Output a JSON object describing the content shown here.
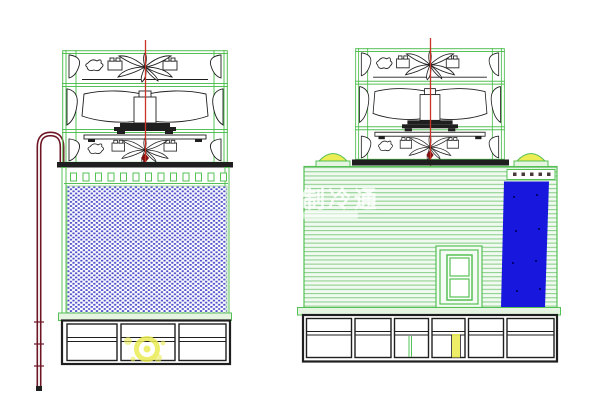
{
  "watermark": {
    "title": "制冷通"
  },
  "drawing": {
    "left_view": "cooling-tower-side-elevation",
    "right_view": "cooling-tower-front-elevation",
    "left_basin_panels": 3,
    "right_basin_panels": 6,
    "fan_stages": 2
  },
  "colors": {
    "green": "#55c055",
    "green-light": "#a6d9a6",
    "stripe": "#8fd08f",
    "stripe-bg": "#f1faf1",
    "fill-blue": "#5050cc",
    "blue": "#1717dd",
    "red": "#cc3327",
    "red-dark": "#7c1010",
    "pipe": "#6e1524",
    "yellow": "#ecec55",
    "rim": "#e6f5e2",
    "ink": "#1f1f1f",
    "bolt": "#4a3a3a"
  }
}
